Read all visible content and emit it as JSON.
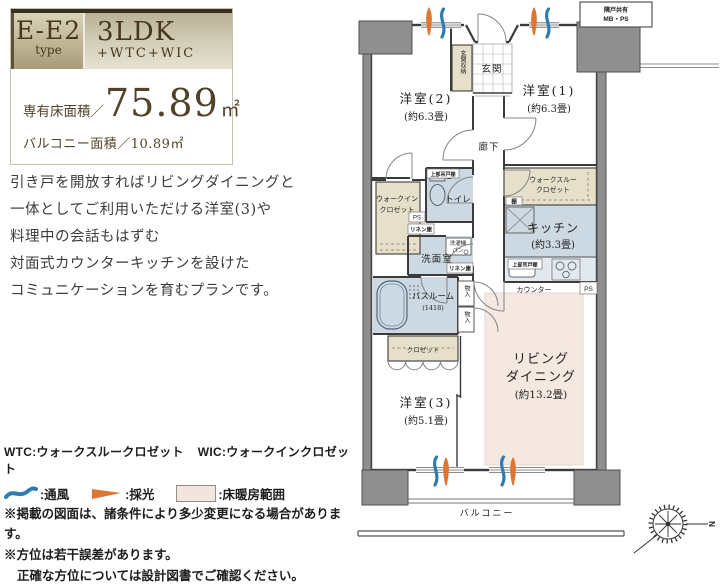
{
  "title_card": {
    "type_value": "E-E2",
    "type_label": "type",
    "layout": "3LDK",
    "layout_sub": "+WTC+WIC",
    "area_label": "専有床面積／",
    "area_value": "75.89",
    "area_unit": "㎡",
    "balcony_label": "バルコニー面積／10.89㎡"
  },
  "description": {
    "lines": [
      "引き戸を開放すればリビングダイニングと",
      "一体としてご利用いただける洋室(3)や",
      "料理中の会話もはずむ",
      "対面式カウンターキッチンを設けた",
      "コミュニケーションを育むプランです。"
    ]
  },
  "legend": {
    "abbr_wtc": "WTC:ウォークスルークロゼット",
    "abbr_wic": "WIC:ウォークインクロゼット",
    "vent_label": ":通風",
    "light_label": ":採光",
    "heating_label": ":床暖房範囲",
    "note1": "※掲載の図面は、諸条件により多少変更になる場合があります。",
    "note2": "※方位は若干誤差があります。",
    "note3": "正確な方位については設計図書でご確認ください。"
  },
  "floorplan": {
    "rooms": {
      "western2_name": "洋室(2)",
      "western2_size": "(約6.3畳)",
      "western1_name": "洋室(1)",
      "western1_size": "(約6.3畳)",
      "western3_name": "洋室(3)",
      "western3_size": "(約5.1畳)",
      "living_line1": "リビング",
      "living_line2": "ダイニング",
      "living_size": "(約13.2畳)",
      "kitchen_name": "キッチン",
      "kitchen_size": "(約3.3畳)",
      "entrance": "玄関",
      "entrance_storage": "玄関収納",
      "hallway": "廊下",
      "toilet": "トイレ",
      "washroom": "洗面室",
      "bathroom_name": "バスルーム",
      "bathroom_size": "(1418)",
      "wic_line1": "ウォークイン",
      "wic_line2": "クロゼット",
      "wtc_line1": "ウォークスルー",
      "wtc_line2": "クロゼット",
      "closet": "クロゼット",
      "balcony": "バルコニー",
      "counter": "カウンター"
    },
    "small_labels": {
      "ps": "PS",
      "linen": "リネン庫",
      "shelf": "棚",
      "upper_cabinet": "上部吊戸棚",
      "washer_line1": "洗濯機",
      "washer_line2": "パン",
      "storage_vertical": "物入",
      "mbps_line1": "隣戸共有",
      "mbps_line2": "MB・PS"
    },
    "compass": {
      "north": "N"
    }
  },
  "colors": {
    "accent_orange": "#dd7631",
    "accent_blue": "#2f7cb3",
    "wet_room": "#ccd9e2",
    "closet_beige": "#e6dfca",
    "floor_heating": "#f4e8e1",
    "wall_gray": "#8f8f8f"
  }
}
